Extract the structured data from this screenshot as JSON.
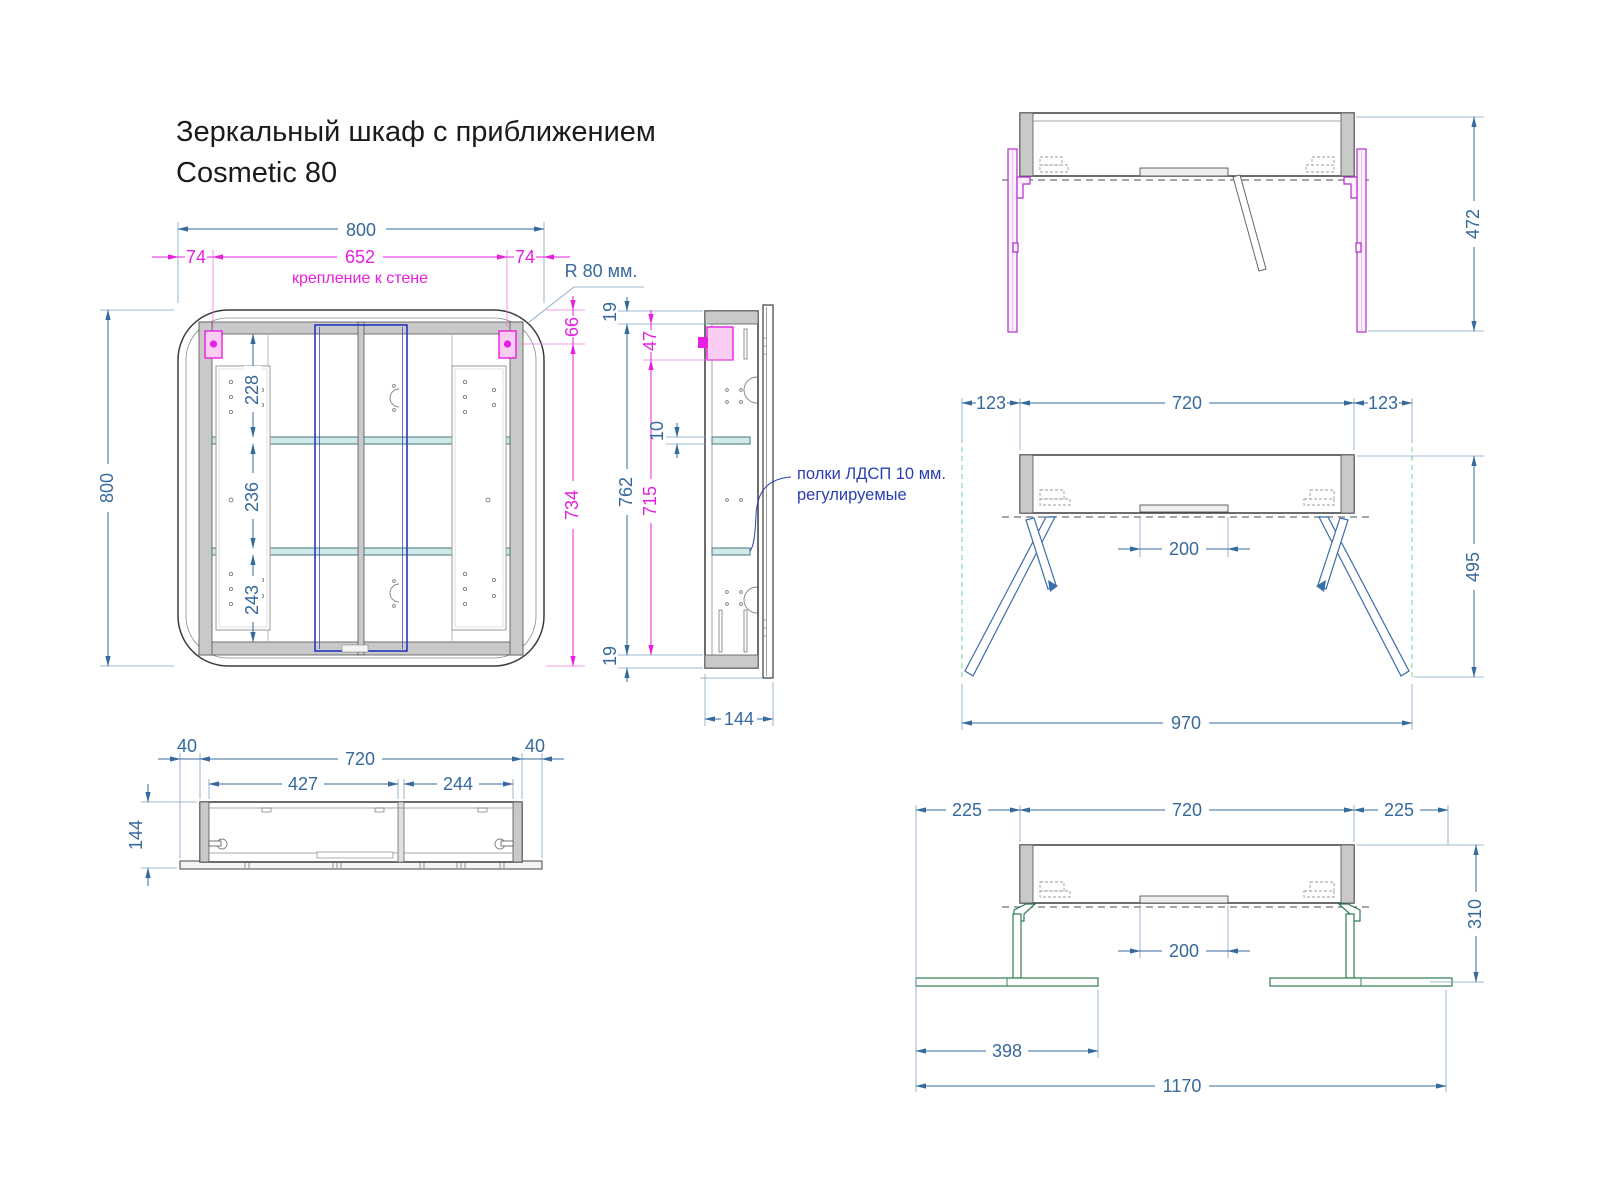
{
  "title": {
    "line1": "Зеркальный шкаф с приближением",
    "line2": "Cosmetic 80"
  },
  "colors": {
    "dimension_blue": "#36699c",
    "dimension_magenta": "#e81ee0",
    "note_blue": "#2b3fb5",
    "shelf_teal": "#cfe8e8",
    "rail_purple": "#b32ccc",
    "leg_blue": "#3a6ea8",
    "bracket_green": "#2e7d52",
    "guide_green": "#90d9a8"
  },
  "front_view": {
    "total_width": "800",
    "mount_left": "74",
    "mount_span": "652",
    "mount_right": "74",
    "mount_note": "крепление к стене",
    "corner_radius": "R 80 мм.",
    "total_height": "800",
    "section_top": "228",
    "section_mid": "236",
    "section_bottom": "243",
    "mount_from_top": "66",
    "mount_to_bottom": "734"
  },
  "side_view": {
    "panel_top": "19",
    "mount_offset": "47",
    "inner_height": "762",
    "mount_inner": "715",
    "shelf_thickness": "10",
    "panel_bottom": "19",
    "depth": "144",
    "note_line1": "полки ЛДСП 10 мм.",
    "note_line2": "регулируемые"
  },
  "plan_view": {
    "overhang_left": "40",
    "body_width": "720",
    "overhang_right": "40",
    "door_left": "427",
    "door_right": "244",
    "depth": "144"
  },
  "open_view": {
    "height": "472"
  },
  "legs_view": {
    "offset_left": "123",
    "width": "720",
    "offset_right": "123",
    "center_gap": "200",
    "height": "495",
    "span": "970"
  },
  "wall_view": {
    "offset_left": "225",
    "width": "720",
    "offset_right": "225",
    "center_gap": "200",
    "height": "310",
    "foot_width": "398",
    "span": "1170"
  }
}
